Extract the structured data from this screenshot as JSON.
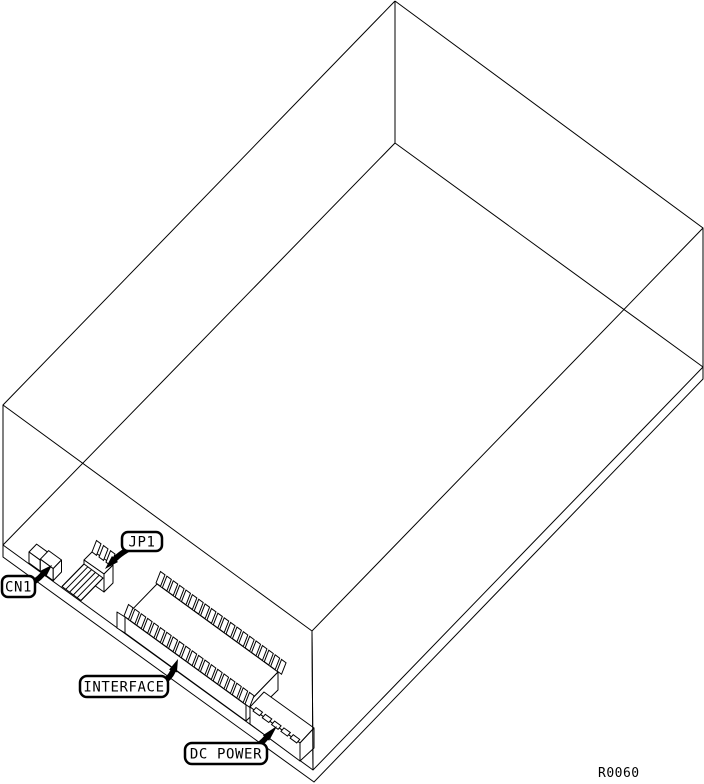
{
  "figure": {
    "callouts": [
      {
        "id": "cn1",
        "label": "CN1"
      },
      {
        "id": "jp1",
        "label": "JP1"
      },
      {
        "id": "interface",
        "label": "INTERFACE"
      },
      {
        "id": "dc_power",
        "label": "DC POWER"
      }
    ],
    "reference": "R0060",
    "colors": {
      "line": "#000000",
      "background": "#ffffff"
    }
  }
}
